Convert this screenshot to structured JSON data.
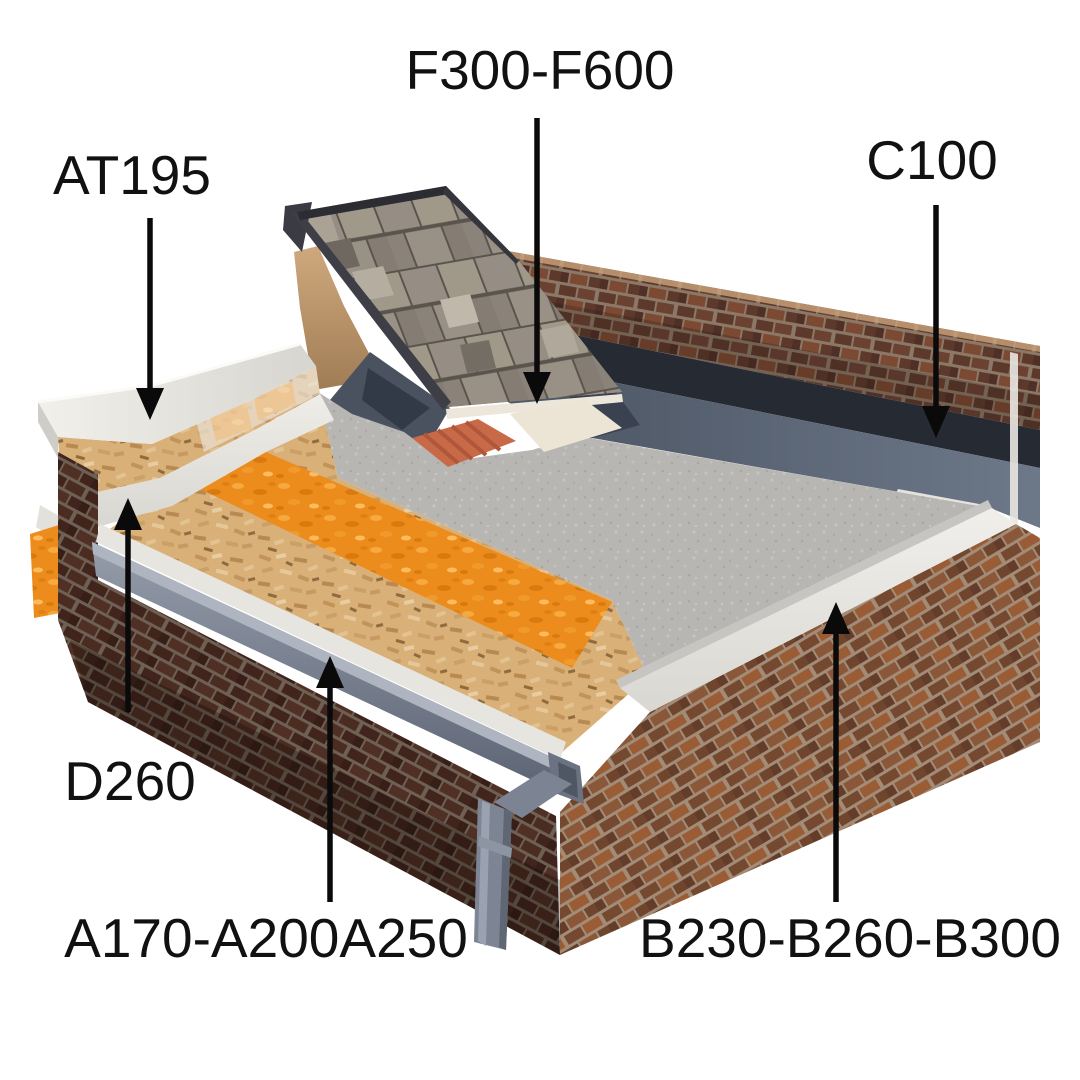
{
  "labels": {
    "f300": "F300-F600",
    "at195": "AT195",
    "c100": "C100",
    "d260": "D260",
    "a170": "A170-A200A250",
    "b230": "B230-B260-B300"
  },
  "colors": {
    "background": "#ffffff",
    "label_text": "#111111",
    "arrow": "#0a0a0a",
    "insulation_orange": "#ec8c1d",
    "osb_board_tan": "#d8b078",
    "membrane_gray": "#b8b6b3",
    "upstand_blue_gray": "#525c6e",
    "brick_front_dark": "#41251c",
    "brick_right_light": "#815136",
    "brick_back": "#6b4232",
    "roof_tile_gray": "#968e84",
    "gutter_gray": "#78808f",
    "trim_white": "#eceae5",
    "verge_tile_terracotta": "#c86a47",
    "flashing_cream": "#ece5d5"
  }
}
